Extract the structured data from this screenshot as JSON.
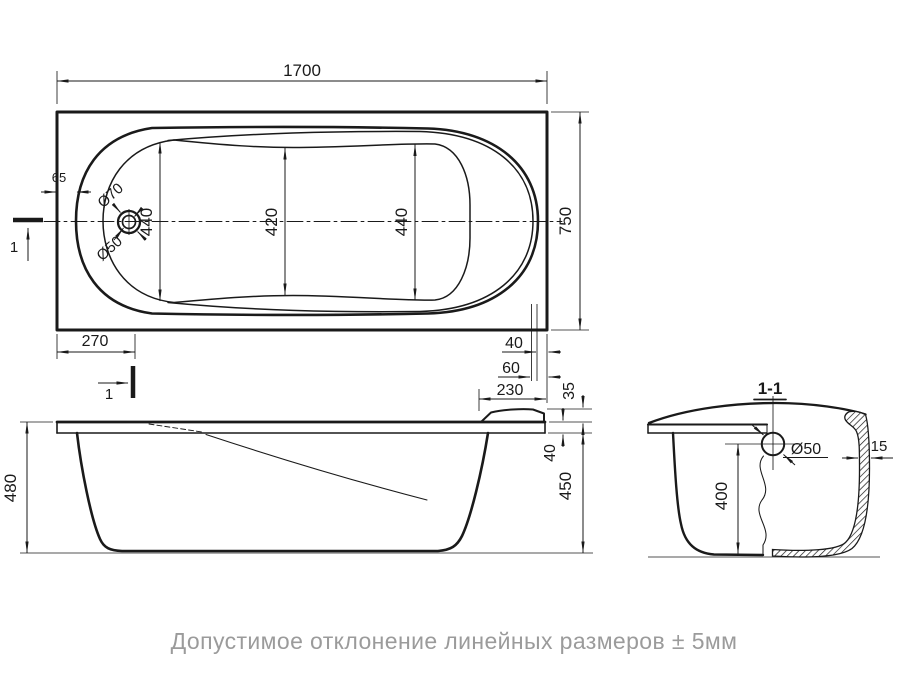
{
  "drawing": {
    "footer_note": "Допустимое отклонение линейных размеров ± 5мм",
    "top_view": {
      "overall_length": "1700",
      "overall_width": "750",
      "bottom_width_left": "440",
      "bottom_width_middle": "420",
      "bottom_width_right": "440",
      "rim_offset": "65",
      "drain_outer_dia": "Ø70",
      "drain_inner_dia": "Ø50",
      "drain_from_end": "270",
      "overflow_offset_a": "40",
      "overflow_offset_b": "60",
      "headrest_length": "230",
      "headrest_height": "35",
      "cut_label": "1"
    },
    "side_view": {
      "overall_height": "480",
      "body_height": "450",
      "rim_height": "40"
    },
    "section_view": {
      "title": "1-1",
      "overflow_dia": "Ø50",
      "overflow_height": "400",
      "wall_thickness": "15"
    }
  }
}
